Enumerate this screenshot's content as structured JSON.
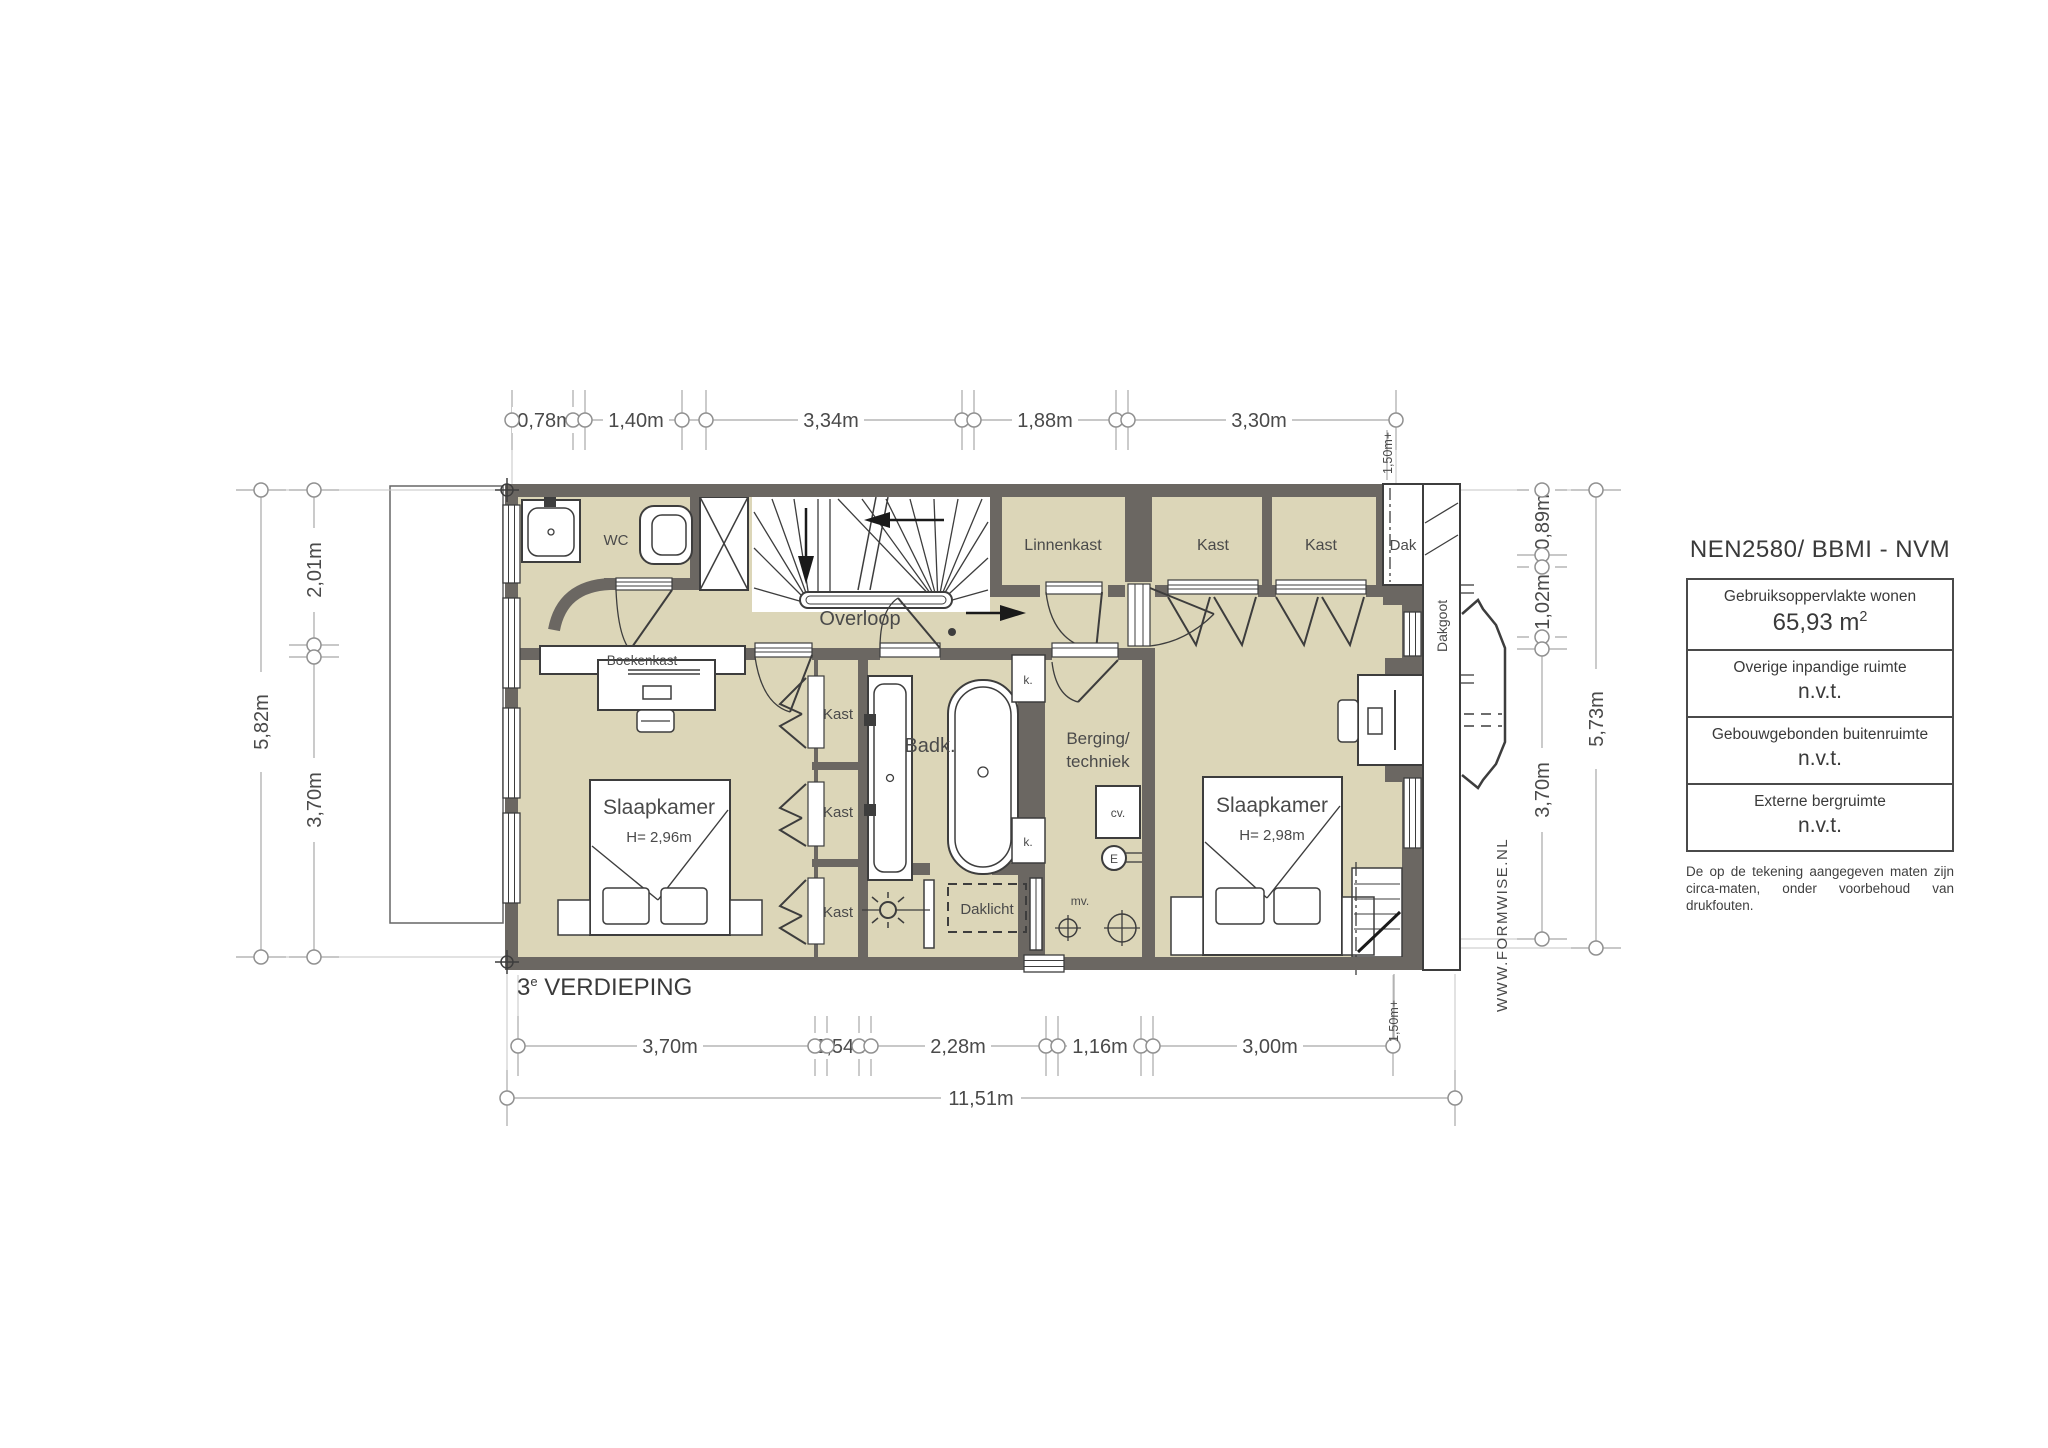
{
  "floor_label": {
    "num": "3",
    "sup": "e",
    "rest": " VERDIEPING"
  },
  "plan": {
    "rooms": {
      "wc": "WC",
      "overloop": "Overloop",
      "linnenkast": "Linnenkast",
      "kast_top_1": "Kast",
      "kast_top_2": "Kast",
      "kast_col_1": "Kast",
      "kast_col_2": "Kast",
      "kast_col_3": "Kast",
      "badk": "Badk.",
      "berging_line1": "Berging/",
      "berging_line2": "techniek",
      "slaapkamer_left": {
        "name": "Slaapkamer",
        "height": "H= 2,96m"
      },
      "slaapkamer_right": {
        "name": "Slaapkamer",
        "height": "H= 2,98m"
      },
      "boekenkast": "Boekenkast",
      "daklicht": "Daklicht",
      "dak": "Dak",
      "dakgoot": "Dakgoot"
    },
    "fixtures": {
      "k_top": "k.",
      "k_bottom": "k.",
      "cv": "cv.",
      "e": "E",
      "mv": "mv."
    }
  },
  "dimensions": {
    "top": [
      "0,78m",
      "1,40m",
      "3,34m",
      "1,88m",
      "3,30m"
    ],
    "bottom": [
      "3,70m",
      "0,54m",
      "2,28m",
      "1,16m",
      "3,00m"
    ],
    "bottom_total": "11,51m",
    "left_outer": "5,82m",
    "left_segments": [
      "2,01m",
      "3,70m"
    ],
    "right_outer": "5,73m",
    "right_segments": [
      "0,89m",
      "1,02m",
      "3,70m"
    ],
    "right_top_offset": "1,50m+",
    "right_bottom_offset": "1,50m+"
  },
  "info_panel": {
    "title": "NEN2580/ BBMI - NVM",
    "rows": [
      {
        "label": "Gebruiksoppervlakte wonen",
        "value": "65,93 m",
        "value_sup": "2"
      },
      {
        "label": "Overige inpandige ruimte",
        "value": "n.v.t.",
        "value_sup": ""
      },
      {
        "label": "Gebouwgebonden buitenruimte",
        "value": "n.v.t.",
        "value_sup": ""
      },
      {
        "label": "Externe bergruimte",
        "value": "n.v.t.",
        "value_sup": ""
      }
    ],
    "disclaimer_line1": "De op de tekening aangegeven maten zijn",
    "disclaimer_line2": "circa-maten, onder voorbehoud van drukfouten."
  },
  "watermark": "WWW.FORMWISE.NL",
  "colors": {
    "wall": "#6b6762",
    "floor": "#dcd6b8",
    "dim": "#9b9b9b",
    "line": "#3d3d3d"
  }
}
